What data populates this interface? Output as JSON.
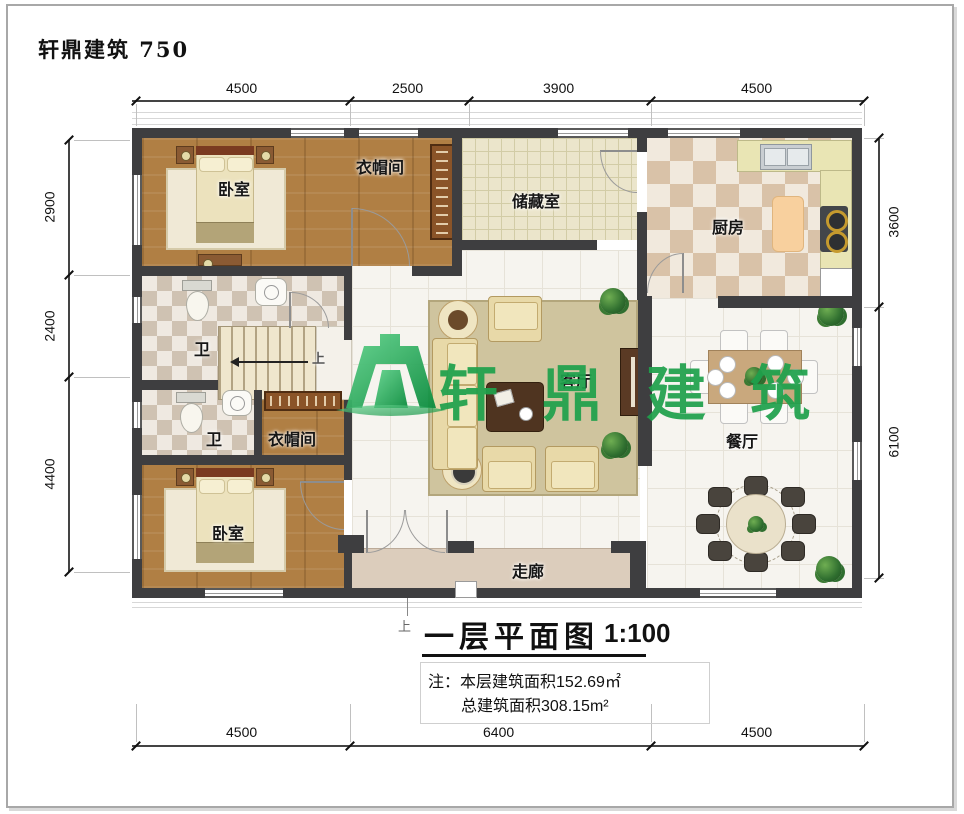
{
  "brand": {
    "title": "轩鼎建筑  750"
  },
  "watermark": {
    "text": "轩鼎建筑",
    "color": "#1fa14c"
  },
  "rooms": {
    "bedroom_top": "卧室",
    "closet_top": "衣帽间",
    "storage": "储藏室",
    "kitchen": "厨房",
    "bath_upper": "卫",
    "bath_lower": "卫",
    "closet_mid": "衣帽间",
    "bedroom_bottom": "卧室",
    "living": "客厅",
    "dining": "餐厅",
    "corridor": "走廊",
    "stairs_up": "上"
  },
  "dimensions": {
    "top": [
      "4500",
      "2500",
      "3900",
      "4500"
    ],
    "left": [
      "2900",
      "2400",
      "4400"
    ],
    "right": [
      "3600",
      "6100"
    ],
    "bottom": [
      "4500",
      "6400",
      "4500"
    ]
  },
  "title_block": {
    "title": "一层平面图",
    "scale": "1:100",
    "note_label": "注：",
    "note_line1": "本层建筑面积152.69㎡",
    "note_line2": "总建筑面积308.15m²"
  },
  "colors": {
    "wall": "#3e3e40",
    "watermark_green": "#1fa14c"
  }
}
